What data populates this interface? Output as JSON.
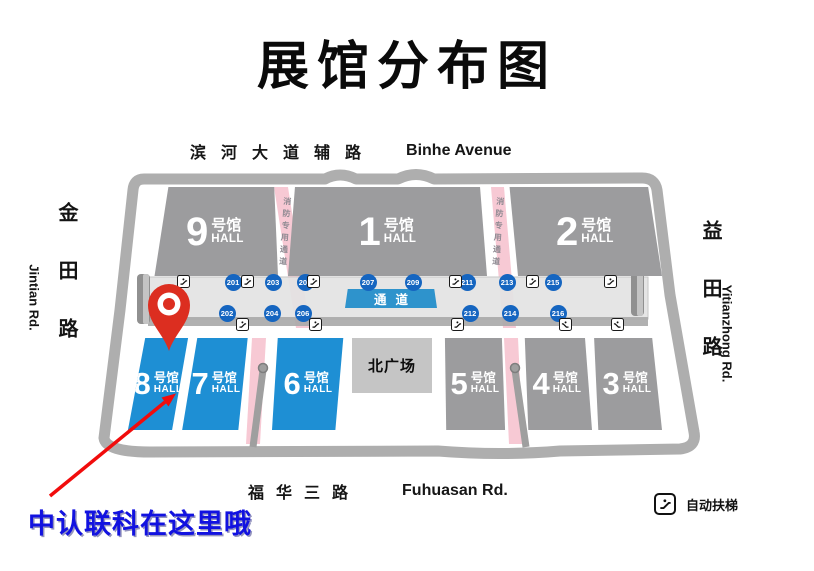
{
  "title": "展馆分布图",
  "roads": {
    "top_zh": "滨河大道辅路",
    "top_en": "Binhe Avenue",
    "left_zh": "金田路",
    "left_en": "Jintian Rd.",
    "right_zh": "益田路",
    "right_en": "Yitianzhong Rd.",
    "bottom_zh": "福华三路",
    "bottom_en": "Fuhuasan Rd."
  },
  "halls": [
    {
      "num": "9",
      "type": "号馆",
      "hall": "HALL"
    },
    {
      "num": "1",
      "type": "号馆",
      "hall": "HALL"
    },
    {
      "num": "2",
      "type": "号馆",
      "hall": "HALL"
    },
    {
      "num": "8",
      "type": "号馆",
      "hall": "HALL"
    },
    {
      "num": "7",
      "type": "号馆",
      "hall": "HALL"
    },
    {
      "num": "6",
      "type": "号馆",
      "hall": "HALL"
    },
    {
      "num": "5",
      "type": "号馆",
      "hall": "HALL"
    },
    {
      "num": "4",
      "type": "号馆",
      "hall": "HALL"
    },
    {
      "num": "3",
      "type": "号馆",
      "hall": "HALL"
    }
  ],
  "plaza": "北广场",
  "corridor_label": "通道",
  "booths_top": [
    "201",
    "203",
    "205",
    "207",
    "209",
    "211",
    "213",
    "215"
  ],
  "booths_bottom": [
    "202",
    "204",
    "206",
    "212",
    "214",
    "216"
  ],
  "fire_lane": "消防专用通道",
  "legend_escalator": "自动扶梯",
  "caption": "中认联科在这里哦",
  "colors": {
    "hall_blue": "#1e8fd4",
    "hall_gray": "#9c9c9e",
    "booth_blue": "#1565c0",
    "corridor_box_blue": "#2e93cc",
    "lane_pink": "#f7c9d4",
    "road_gray": "#aeaeae",
    "pin_red": "#dc2e20",
    "arrow_red": "#f10c0c",
    "caption_blue": "#1212e0"
  }
}
